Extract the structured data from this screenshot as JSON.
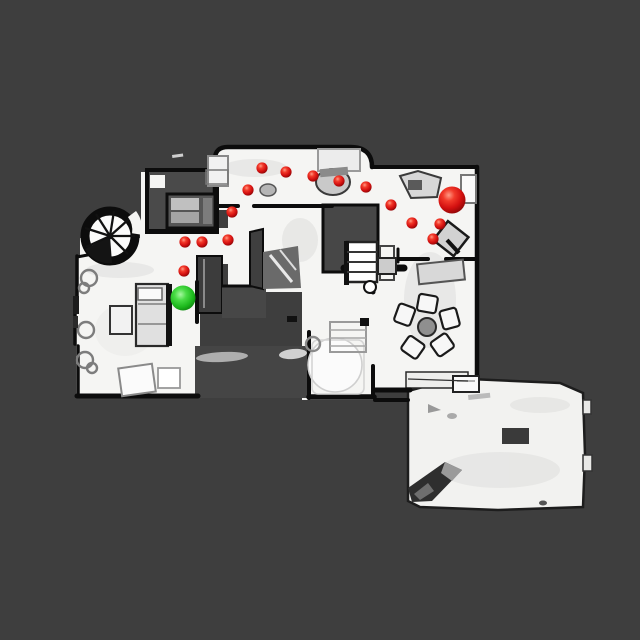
{
  "scene": {
    "kind": "top-down-floorplan-scan",
    "background_color": "#3e3e3e",
    "floor_color": "#f5f5f3",
    "wall_color": "#0c0c0c",
    "unscanned_patch_color": "#4a4a4a"
  },
  "markers": {
    "goal_sphere": {
      "label": "green-sphere",
      "x": 183,
      "y": 298,
      "r": 12.5,
      "color": "#23c523"
    },
    "agent_sphere": {
      "label": "large-red-sphere",
      "x": 452,
      "y": 200,
      "r": 13.5,
      "color": "#d61111"
    },
    "waypoints": {
      "color": "#d61111",
      "r": 5.6,
      "points": [
        [
          262,
          168
        ],
        [
          286,
          172
        ],
        [
          313,
          176
        ],
        [
          339,
          181
        ],
        [
          366,
          187
        ],
        [
          248,
          190
        ],
        [
          232,
          212
        ],
        [
          391,
          205
        ],
        [
          185,
          242
        ],
        [
          202,
          242
        ],
        [
          228,
          240
        ],
        [
          412,
          223
        ],
        [
          440,
          224
        ],
        [
          433,
          239
        ],
        [
          184,
          271
        ]
      ]
    }
  }
}
